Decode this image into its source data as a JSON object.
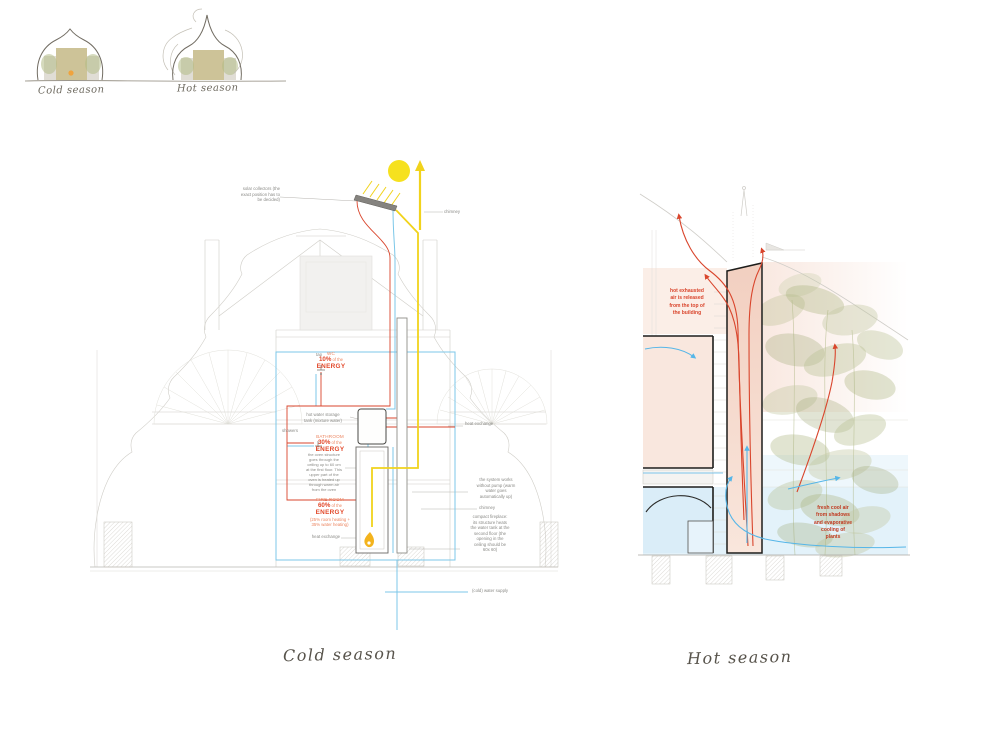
{
  "sketches": {
    "cold_caption": "Cold season",
    "hot_caption": "Hot season"
  },
  "captions": {
    "cold": "Cold season",
    "hot": "Hot season"
  },
  "cold_section": {
    "labels": {
      "solar_collectors": "solar collectors (the\nexact position has to\nbe decided)",
      "chimney_upper": "chimney",
      "tap": "tap",
      "showers": "showers",
      "tank_note": "hot water storage\ntank (mixture water)",
      "oven_note": "the oven structure\ngoes through the\nceiling up to 60 cm\nat the first floor. This\nupper part of the\noven is heated up\nthrough warm air\nfrom the oven",
      "heat_exchange_left": "heat exchange",
      "heat_exchange_right": "heat exchange",
      "no_pump_note": "the system works\nwithout pump (warm\nwater goes\nautomatically up)",
      "chimney_lower": "chimney",
      "fireplace_note": "compact fireplace:\nits structure heats\nthe water tank at the\nsecond floor (the\nopening in the\nceiling should be\n60x 60)",
      "water_supply": "(cold) water supply"
    },
    "energy": {
      "wc": {
        "room": "WC",
        "pct": "10%",
        "suffix": "of the",
        "word": "ENERGY"
      },
      "bathroom": {
        "room": "BATHROOM",
        "pct": "30%",
        "suffix": "of the",
        "word": "ENERGY"
      },
      "fire_room": {
        "room": "FIRE ROOM",
        "pct": "60%",
        "suffix": "of the",
        "word": "ENERGY",
        "detail": "(25% room heating +\n35% water heating)"
      }
    }
  },
  "hot_section": {
    "exhaust_note": "hot exhausted\nair is released\nfrom the top of\nthe building",
    "fresh_air_note": "fresh cool air\nfrom shadows\nand evaporative\ncooling of\nplants"
  },
  "colors": {
    "hot_pipe": "#d9452c",
    "cold_pipe": "#7cc7e8",
    "flue": "#f1d31c",
    "sun": "#f6e11f",
    "annotation_red": "#e2482a",
    "warm_wash": "#f6ddd2",
    "cool_wash": "#d9edf8",
    "plant_green": "#a9b37c"
  }
}
